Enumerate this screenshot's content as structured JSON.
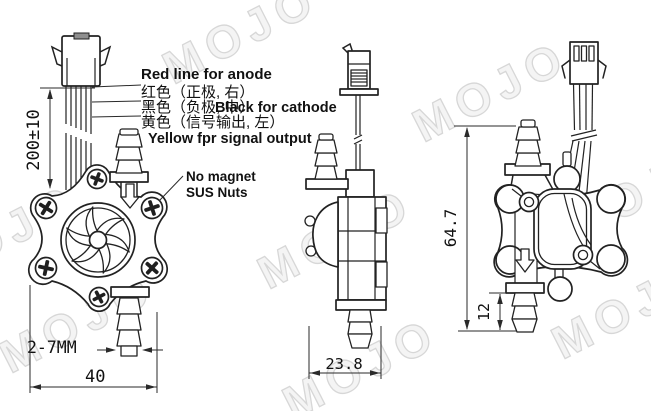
{
  "watermark": "MOJO",
  "wiring": {
    "red_en": "Red line for anode",
    "red_cn": "红色（正极, 右）",
    "black_cn": "黑色（负极, 中）",
    "black_en": "Black for cathode",
    "yellow_cn": "黄色（信号输出, 左）",
    "yellow_en": "Yellow fpr signal output"
  },
  "notes": {
    "line1": "No magnet",
    "line2": "SUS Nuts"
  },
  "dimensions": {
    "wire_length": "200±10",
    "barb_od_range": "2-7MM",
    "front_width": "40",
    "side_depth": "23.8",
    "back_height": "64.7",
    "barb_length": "12"
  },
  "colors": {
    "red_text": "#ce1f1f",
    "yellow_text": "#f0e000",
    "ink": "#222222"
  }
}
